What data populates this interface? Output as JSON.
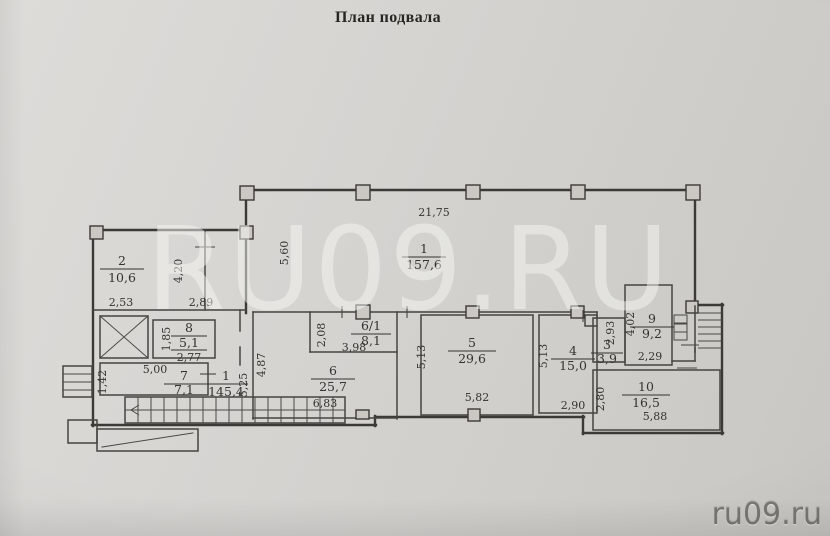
{
  "title": "План подвала",
  "watermark_text": "RU09.RU",
  "site_watermark": "ru09.ru",
  "colors": {
    "paper": "#d6d4d1",
    "ink": "#3b3a36",
    "watermark_overlay": "#f6f5f2",
    "site_text": "#7a7874"
  },
  "plan": {
    "rooms": [
      {
        "number": "2",
        "area": "10,6"
      },
      {
        "number": "8",
        "area": "5,1"
      },
      {
        "number": "7",
        "area": "7,1"
      },
      {
        "number": "1",
        "area": "157,6"
      },
      {
        "number": "1",
        "area": "145,4"
      },
      {
        "number": "6/1",
        "area": "8,1"
      },
      {
        "number": "6",
        "area": "25,7"
      },
      {
        "number": "5",
        "area": "29,6"
      },
      {
        "number": "4",
        "area": "15,0"
      },
      {
        "number": "3",
        "area": "3,9"
      },
      {
        "number": "9",
        "area": "9,2"
      },
      {
        "number": "10",
        "area": "16,5"
      }
    ],
    "dimensions": [
      "2,53",
      "2,89",
      "4,20",
      "1,85",
      "2,77",
      "5,00",
      "1,42",
      "5,25",
      "21,75",
      "5,60",
      "4,87",
      "2,08",
      "3,98",
      "6,83",
      "5,13",
      "5,82",
      "5,13",
      "2,90",
      "2,93",
      "4,02",
      "2,29",
      "2,80",
      "5,88"
    ]
  }
}
